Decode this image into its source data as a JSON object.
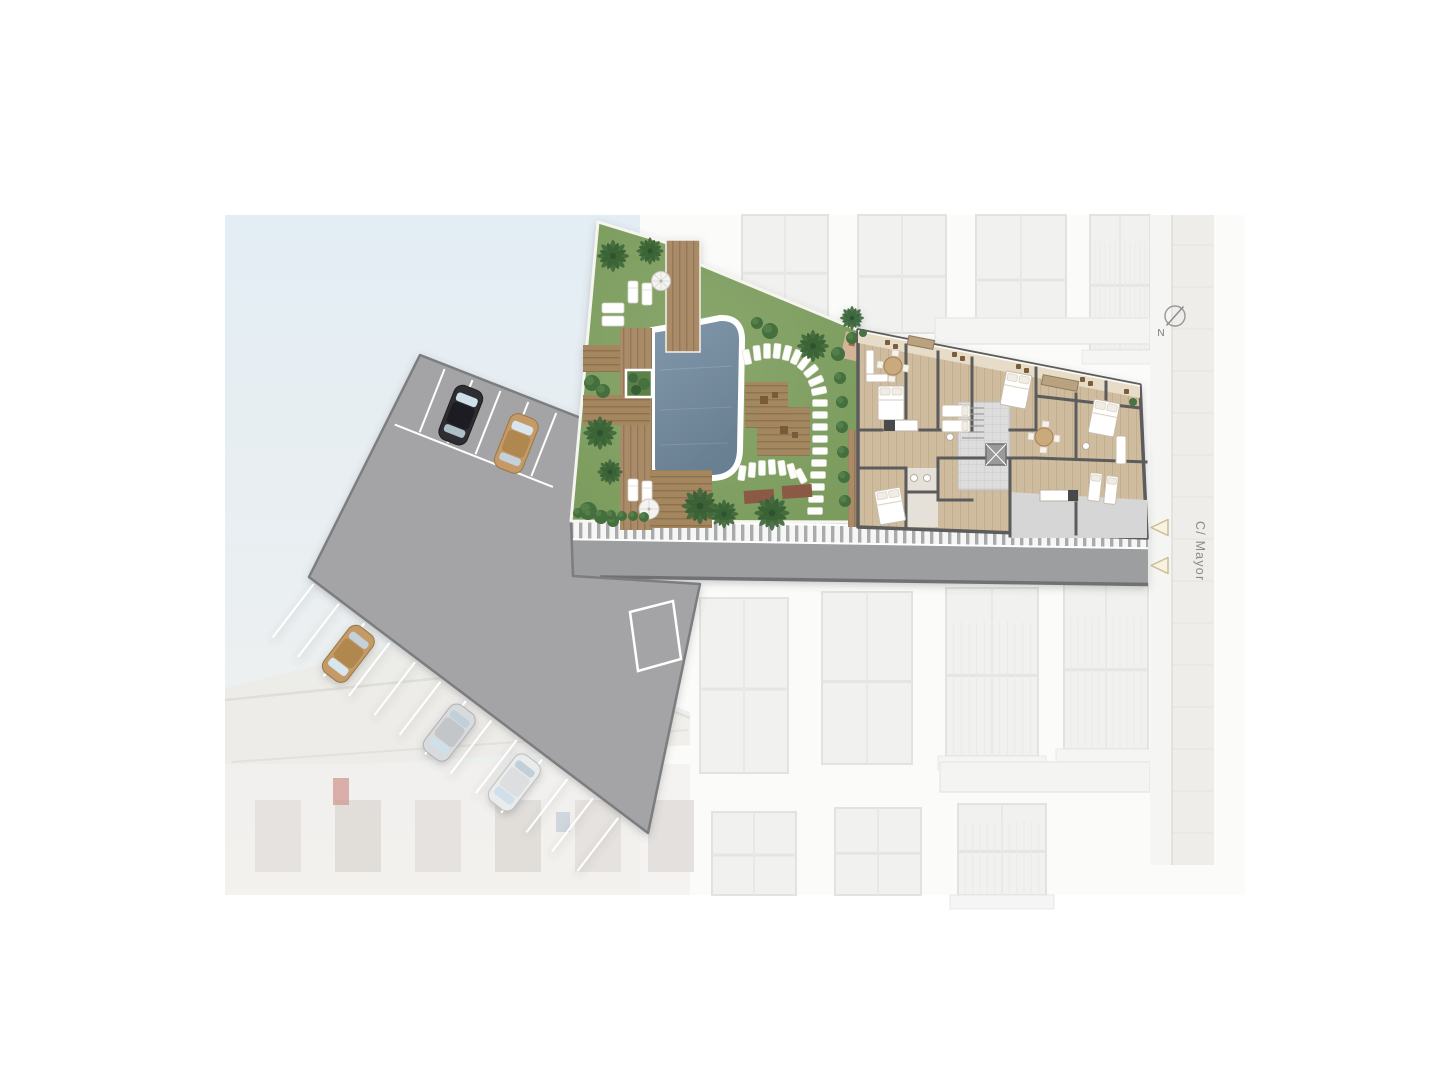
{
  "annotations": {
    "compass": {
      "label": "N",
      "icon": "compass-north-icon"
    },
    "street_label": {
      "text": "C/ Mayor",
      "orientation": "vertical"
    },
    "entrance_markers": {
      "count": 2,
      "direction": "left",
      "icon": "triangle-arrow-icon"
    }
  },
  "site": {
    "parking": {
      "stall_rows": 2,
      "marked_bay": true,
      "cars": [
        {
          "color_name": "black"
        },
        {
          "color_name": "tan"
        },
        {
          "color_name": "tan"
        },
        {
          "color_name": "silver"
        },
        {
          "color_name": "white"
        }
      ]
    },
    "garden": {
      "features": [
        "swimming-pool",
        "timber-decks",
        "sun-loungers",
        "parasols",
        "palm-trees",
        "stepping-stone-path",
        "planter",
        "hedges"
      ]
    },
    "building": {
      "type": "apartment-floor-plan",
      "features": [
        "bedrooms",
        "living-dining",
        "kitchens",
        "bathrooms",
        "stair-core",
        "elevator",
        "street-facing-terraces"
      ]
    }
  },
  "palette": {
    "sky": "#e3edf4",
    "lawn": "#83a264",
    "pool": "#78909f",
    "deck_wood": "#a98b67",
    "floor_wood": "#cfbc9e",
    "paving": "#a4a4a6",
    "road": "#9c9ea0",
    "walls": "#5c5c5c",
    "marker_beige": "#cdbc92",
    "label_gray": "#8b8b8b"
  }
}
